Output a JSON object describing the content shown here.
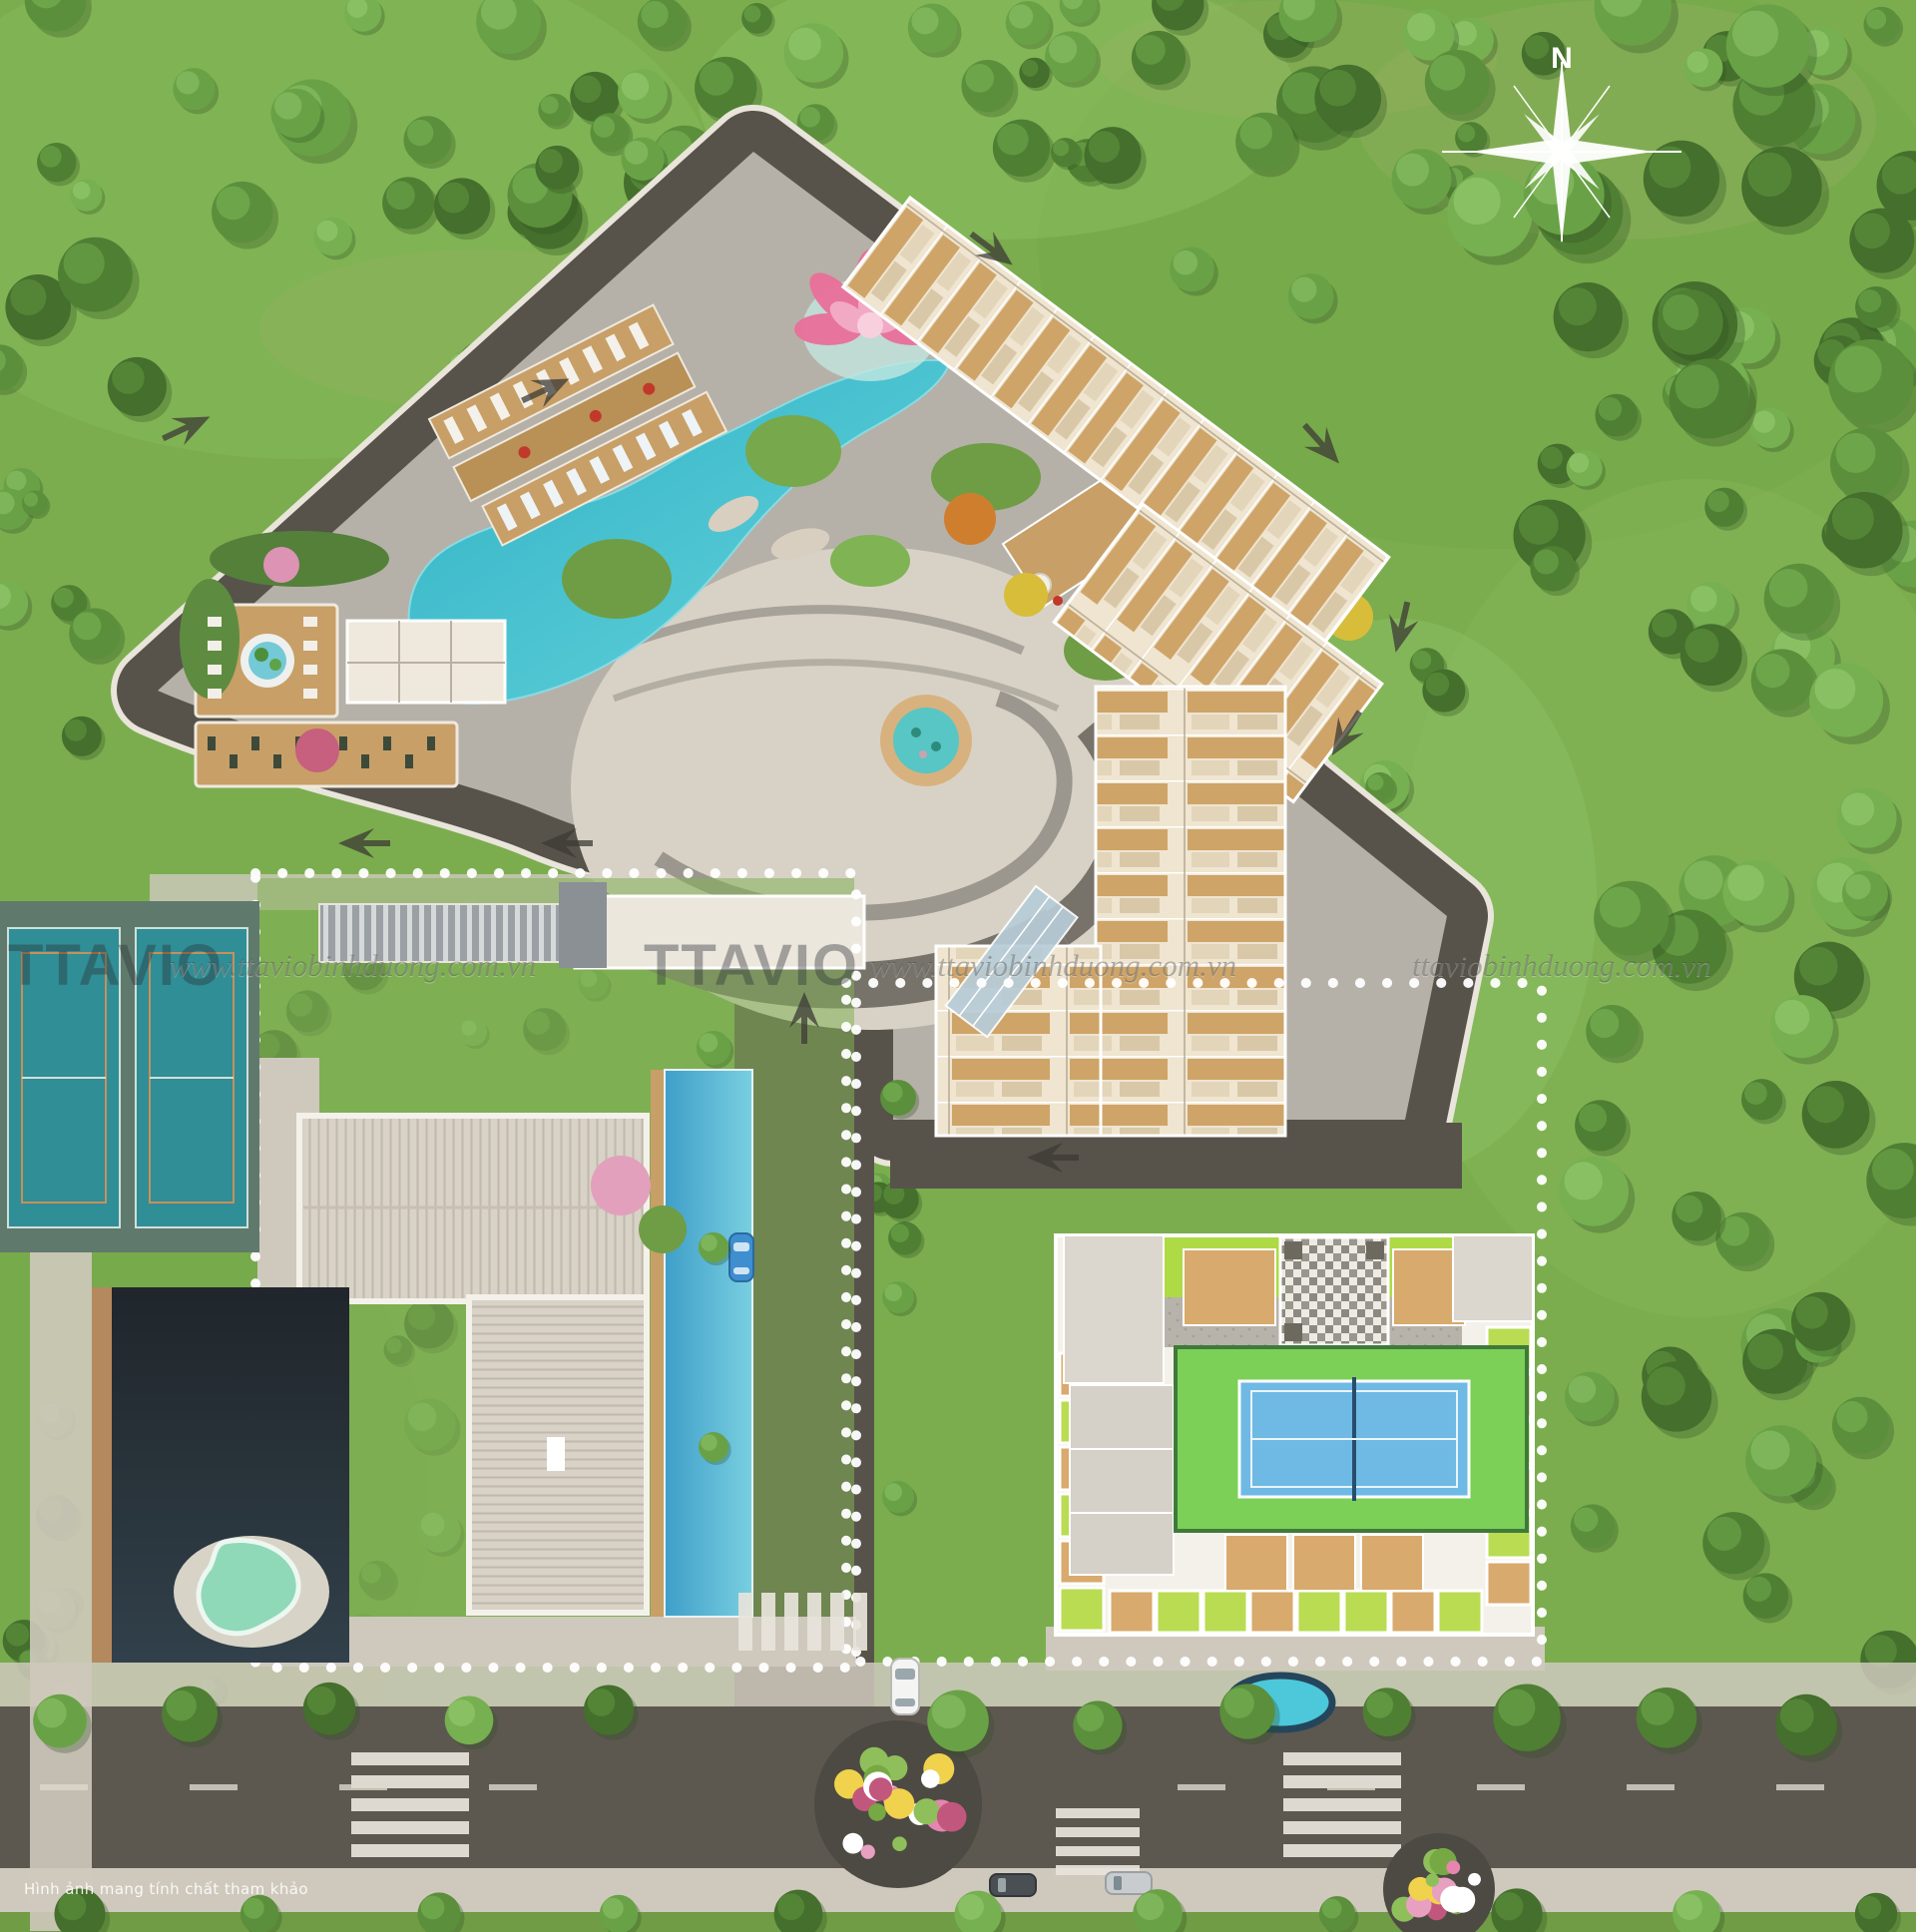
{
  "compass": {
    "label": "N"
  },
  "watermarks": [
    {
      "text": "TTAVIO"
    },
    {
      "text": "www.ttaviobinhduong.com.vn"
    },
    {
      "text": "TTAVIO"
    },
    {
      "text": "www.ttaviobinhduong.com.vn"
    },
    {
      "text": "ttaviobinhduong.com.vn"
    }
  ],
  "caption": {
    "text": "Hình ảnh mang tính chất tham khảo"
  },
  "colors": {
    "grass": "#7BAD4F",
    "tree_green": "#5B8F3B",
    "road": "#57534B",
    "podium_deck": "#B6B1A8",
    "plaza_paving": "#D8D2C6",
    "pool_teal": "#35B9C8",
    "wood_deck": "#C89F67",
    "unit_floor": "#CFA468",
    "unit_base": "#EFE5D0",
    "roof_gray": "#D8D2C7",
    "tennis_teal": "#2F8E96",
    "court_blue": "#6FB9E5",
    "court_green": "#7CD058",
    "lime_lawn": "#AEDA45",
    "lotus_pink": "#EE6F9D",
    "water_dark": "#252B2F",
    "boundary_dots": "#FFFFFF",
    "sidewalk": "#CFC9BD"
  }
}
